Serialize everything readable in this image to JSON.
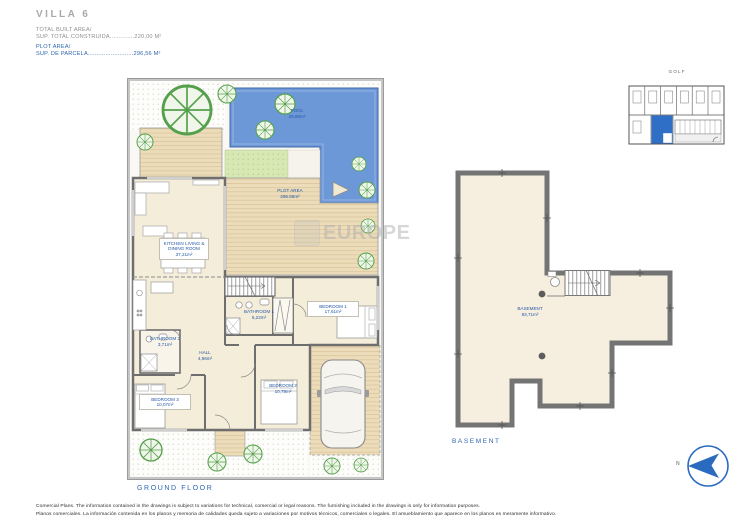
{
  "header": {
    "title": "VILLA 6",
    "built_label": "TOTAL BUILT AREA/",
    "built_value": "SUP. TOTAL CONSTRUIDA..............220,00 M²",
    "plot_label": "PLOT AREA/",
    "plot_value": "SUP. DE PARCELA..........................296,56 M²"
  },
  "ground_floor": {
    "caption": "GROUND FLOOR",
    "labels": {
      "pool": {
        "name": "POOL",
        "area": "29,80m²"
      },
      "plot_area": {
        "name": "PLOT AREA",
        "area": "296.56m²"
      },
      "kitchen": {
        "name": "KITCHEN LIVING & DINING ROOM",
        "area": "37,21m²"
      },
      "bathroom1": {
        "name": "BATHROOM 1",
        "area": "5,22m²"
      },
      "bedroom1": {
        "name": "BEDROOM 1",
        "area": "17,61m²"
      },
      "bathroom2": {
        "name": "BATHROOM 2",
        "area": "3,71m²"
      },
      "hall": {
        "name": "HALL",
        "area": "4,96m²"
      },
      "bedroom2": {
        "name": "BEDROOM 2",
        "area": "10,78m²"
      },
      "bedroom3": {
        "name": "BEDROOM 3",
        "area": "10,07m²"
      }
    }
  },
  "basement": {
    "caption": "BASEMENT",
    "label": {
      "name": "BASEMENT",
      "area": "93,71m²"
    }
  },
  "site_plan": {
    "title": "GOLF"
  },
  "compass": {
    "north": "N"
  },
  "watermark": {
    "text": "EUROPE"
  },
  "footer": {
    "line1": "Comercial Plans. The information contained in the drawings is subject to variations for technical, comercial or legal reasons. The furnishing included in the drawings is only for information purposes.",
    "line2": "Planos comerciales. La información contenida en los planos y memoria de calidades queda sujeto a variaciones por motivos técnicos, comerciales o legales. El amueblamiento que aparece en los planos es meramente informativo."
  },
  "colors": {
    "accent_blue": "#2f6fc6",
    "label_blue": "#2458a6",
    "pool_blue": "#6d98d8",
    "wall_gray": "#6e6e6e",
    "interior_cream": "#f4edda"
  }
}
